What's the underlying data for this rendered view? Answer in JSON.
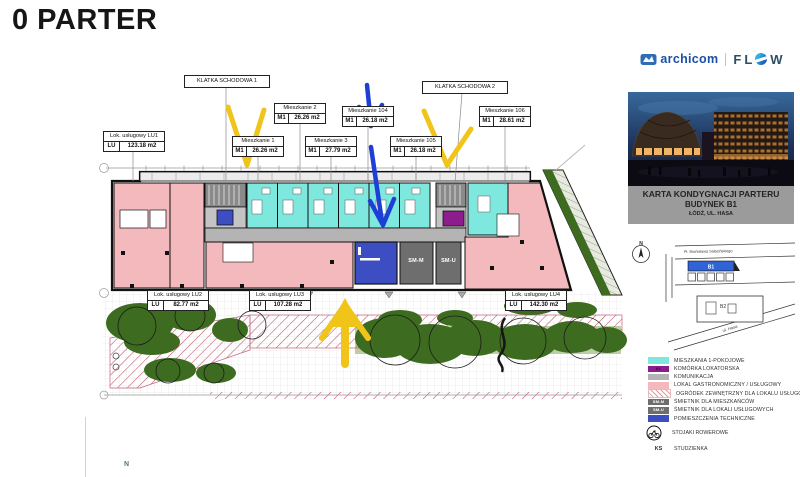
{
  "title": "0 PARTER",
  "plan": {
    "stairs": [
      {
        "label": "KLATKA SCHODOWA 1"
      },
      {
        "label": "KLATKA SCHODOWA 2"
      }
    ],
    "units": [
      {
        "name": "Mieszkanie 1",
        "type": "M1",
        "area": "26.26 m2"
      },
      {
        "name": "Mieszkanie 2",
        "type": "M1",
        "area": "26.26 m2"
      },
      {
        "name": "Mieszkanie 3",
        "type": "M1",
        "area": "27.79 m2"
      },
      {
        "name": "Mieszkanie 104",
        "type": "M1",
        "area": "26.18 m2"
      },
      {
        "name": "Mieszkanie 105",
        "type": "M1",
        "area": "26.18 m2"
      },
      {
        "name": "Mieszkanie 106",
        "type": "M1",
        "area": "28.61 m2"
      }
    ],
    "services": [
      {
        "name": "Lok. usługowy LU1",
        "type": "LU",
        "area": "123.18 m2"
      },
      {
        "name": "Lok. usługowy LU2",
        "type": "LU",
        "area": "82.77 m2"
      },
      {
        "name": "Lok. usługowy LU3",
        "type": "LU",
        "area": "107.28 m2"
      },
      {
        "name": "Lok. usługowy LU4",
        "type": "LU",
        "area": "142.30 m2"
      }
    ],
    "rooms": {
      "smm": "SM-M",
      "smu": "SM-U"
    },
    "north": "N"
  },
  "sidebar": {
    "logos": {
      "archicom": "archicom",
      "flow_f": "F",
      "flow_l": "L",
      "flow_w": "W"
    },
    "card": {
      "line1": "KARTA KONDYGNACJI PARTERU",
      "line2": "BUDYNEK B1",
      "line3": "ŁÓDŹ, UL. HASA"
    },
    "map": {
      "street_top": "Pl. Bronisława Sałacińskiego",
      "street_diagonal": "ul. Hasa",
      "b1": "B1",
      "b2": "B2",
      "north": "N"
    },
    "legend": {
      "items": [
        {
          "label": "MIESZKANIA 1-POKOJOWE",
          "color": "#7fe8de",
          "tag": ""
        },
        {
          "label": "KOMÓRKA LOKATORSKA",
          "color": "#8d1d8d",
          "tag": "KL"
        },
        {
          "label": "KOMUNIKACJA",
          "color": "#b4b4b4",
          "tag": ""
        },
        {
          "label": "LOKAL GASTRONOMICZNY / USŁUGOWY",
          "color": "#f3b9bd",
          "tag": ""
        },
        {
          "label": "OGRÓDEK ZEWNĘTRZNY DLA LOKALU USŁUGOWEGO",
          "color": "hatch",
          "tag": ""
        },
        {
          "label": "ŚMIETNIK DLA MIESZKAŃCÓW",
          "color": "#6e6e6e",
          "tag": "SM-M"
        },
        {
          "label": "ŚMIETNIK DLA LOKALI USŁUGOWYCH",
          "color": "#6e6e6e",
          "tag": "SM-U"
        },
        {
          "label": "POMIESZCZENIA TECHNICZNE",
          "color": "#3c4ec1",
          "tag": ""
        }
      ],
      "bike_label": "STOJAKI ROWEROWE",
      "ks": "KS",
      "ks_label": "STUDZIENKA"
    }
  },
  "colors": {
    "apartment": "#7fe8de",
    "service": "#f3b9bd",
    "corridor": "#b4b4b4",
    "technical": "#3c4ec1",
    "storage": "#8d1d8d",
    "bins": "#6e6e6e",
    "greenery": "#3d6b20",
    "hatch_red": "#c0506a",
    "annotation_yellow": "#f0c419",
    "annotation_blue": "#1d3fd6"
  }
}
